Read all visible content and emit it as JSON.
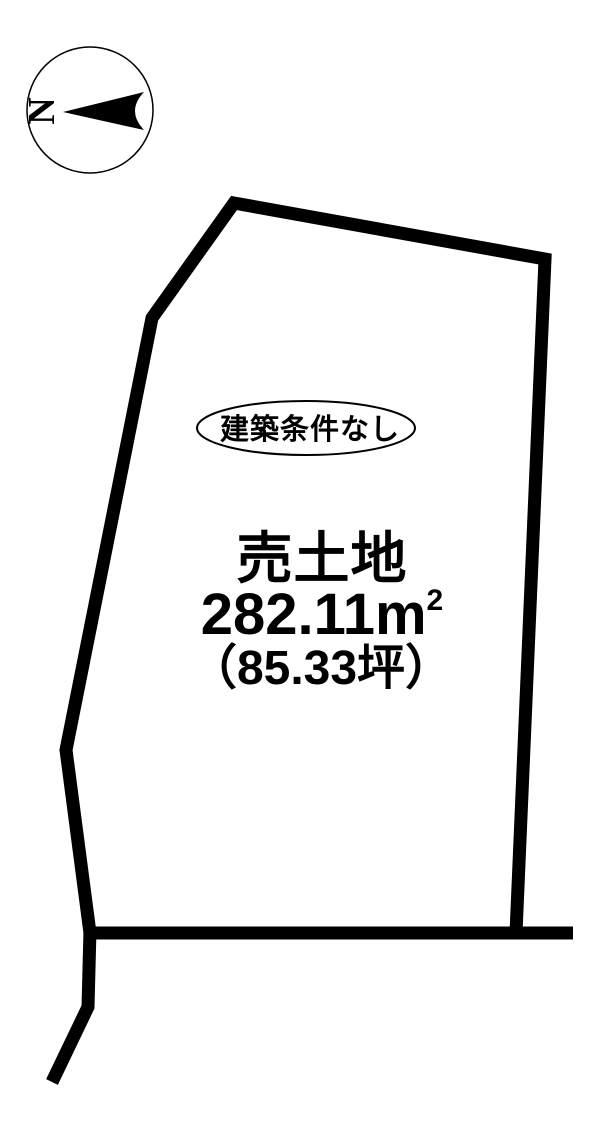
{
  "page": {
    "background": "#ffffff",
    "ink": "#000000"
  },
  "compass": {
    "north_label": "N"
  },
  "lot": {
    "condition_badge": "建築条件なし",
    "listing_type": "売土地",
    "area_sqm": "282.11m",
    "area_sqm_superscript": "2",
    "area_tsubo": "（85.33坪）"
  }
}
